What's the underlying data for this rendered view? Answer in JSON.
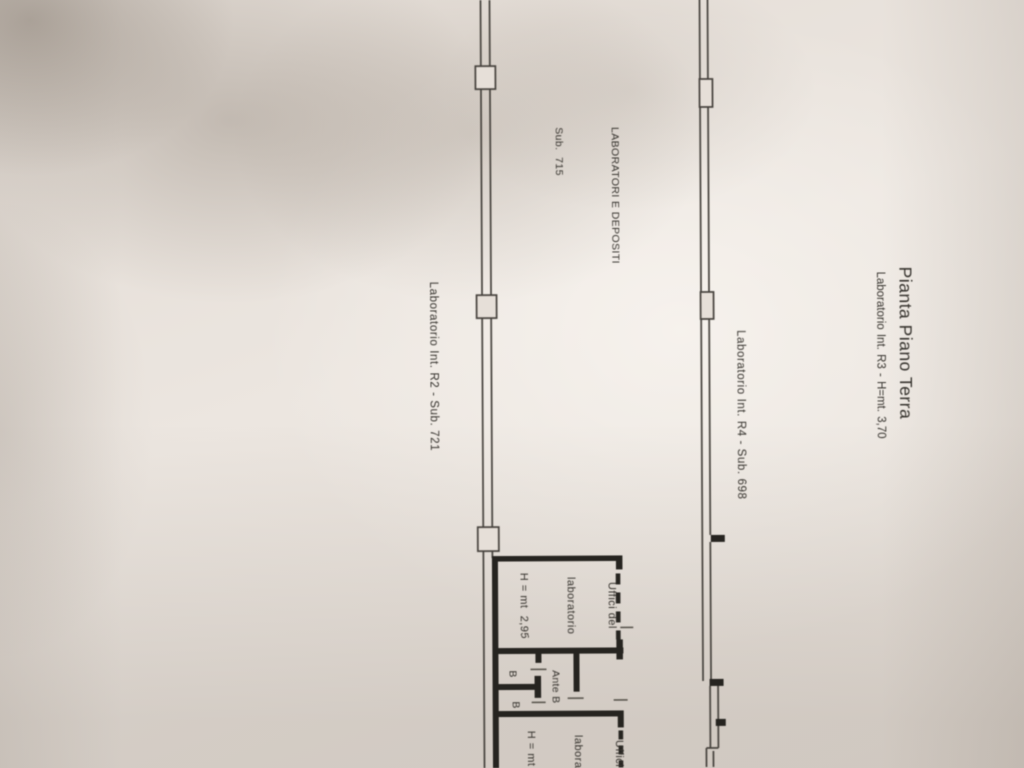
{
  "plan": {
    "title": "Pianta Piano Terra",
    "subtitle": "Laboratorio Int. R3 - H=mt. 3,70",
    "zone": {
      "line1": "LABORATORI E DEPOSITI",
      "line2": "Sub.  715"
    },
    "label_r4": "Laboratorio Int. R4 - Sub. 698",
    "label_r2": "Laboratorio Int. R2 - Sub. 721",
    "office1": {
      "line1": "Uffici del",
      "line2": "laboratorio",
      "line3": "H = mt  2,95"
    },
    "office2": {
      "line1": "Uffici del",
      "line2": "laboratorio",
      "line3": "H = mt  2,95"
    },
    "ante_label": "Ante B",
    "bath_top": "B",
    "bath_bottom": "B",
    "colors": {
      "paper": "#e9e3dc",
      "ink": "#35322d",
      "thin_wall": "#45413c",
      "thick_wall": "#262420"
    }
  }
}
